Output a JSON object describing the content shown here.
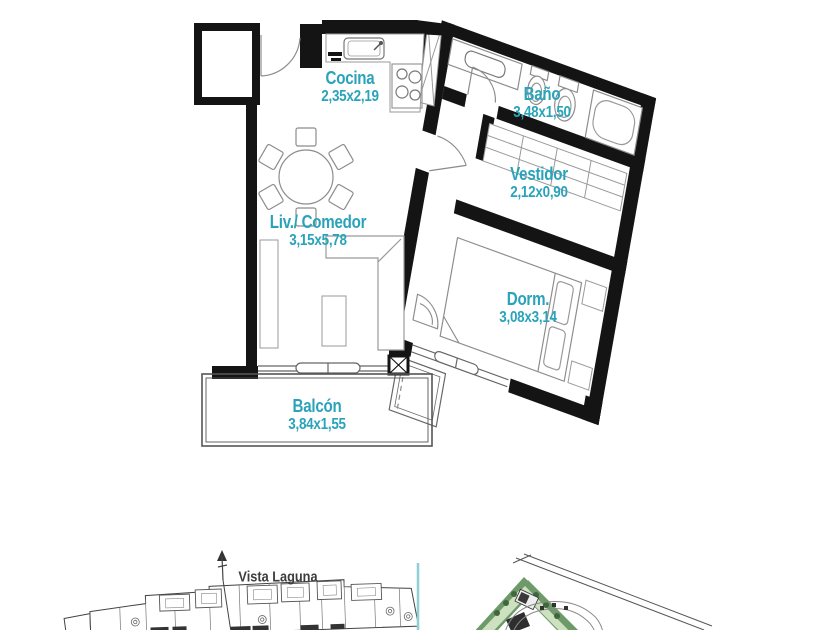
{
  "accent_color": "#2aa3ba",
  "divider_color": "#8fd0d4",
  "floorplan": {
    "rooms": [
      {
        "id": "cocina",
        "name": "Cocina",
        "dims": "2,35x2,19"
      },
      {
        "id": "bano",
        "name": "Baño",
        "dims": "3,48x1,50"
      },
      {
        "id": "vestidor",
        "name": "Vestidor",
        "dims": "2,12x0,90"
      },
      {
        "id": "living",
        "name": "Liv./ Comedor",
        "dims": "3,15x5,78"
      },
      {
        "id": "dorm",
        "name": "Dorm.",
        "dims": "3,08x3,14"
      },
      {
        "id": "balcon",
        "name": "Balcón",
        "dims": "3,84x1,55"
      }
    ]
  },
  "footer": {
    "view_label": "Vista Laguna"
  },
  "icons": {
    "north_arrow": "arrow-up"
  }
}
